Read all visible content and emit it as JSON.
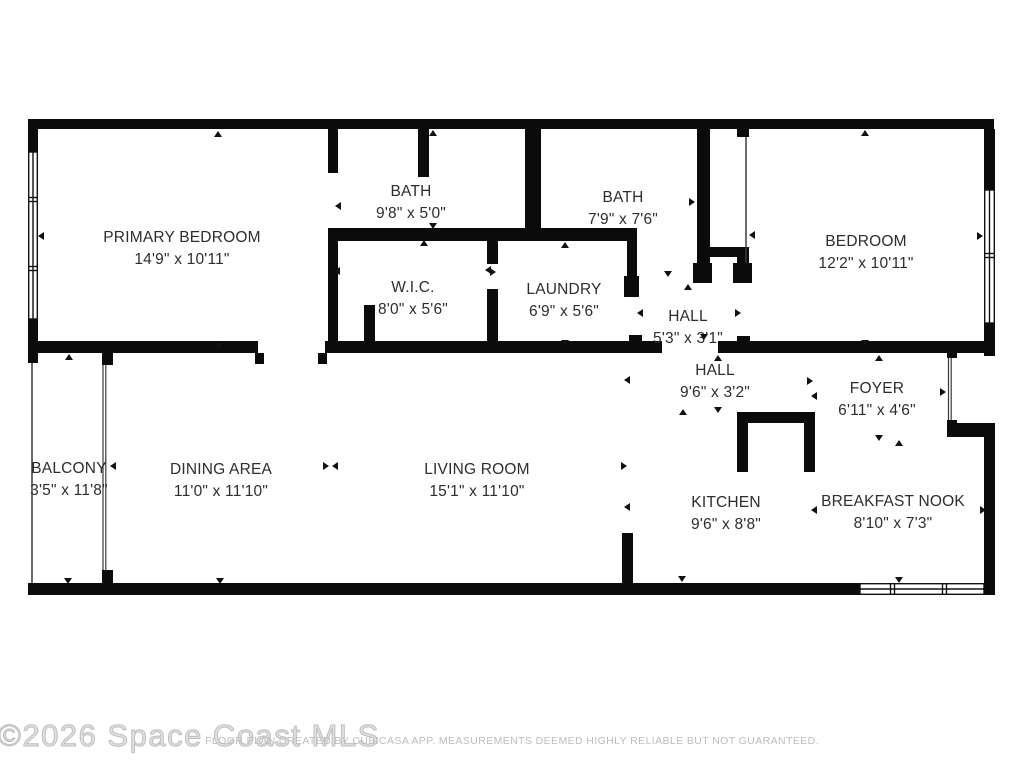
{
  "watermark": {
    "text": "©2026 Space Coast MLS"
  },
  "disclaimer": {
    "text": "FLOOR PLAN CREATED BY CUBICASA APP. MEASUREMENTS DEEMED HIGHLY RELIABLE BUT NOT GUARANTEED."
  },
  "colors": {
    "wall": "#0b0b0b",
    "label": "#2d2d2d",
    "watermark": "#bdbdbd",
    "disclaimer": "#bdbdbd",
    "background": "#ffffff"
  },
  "rooms": [
    {
      "id": "primary-bedroom",
      "name": "PRIMARY BEDROOM",
      "dims": "14'9\" x 10'11\""
    },
    {
      "id": "bath-1",
      "name": "BATH",
      "dims": "9'8\" x 5'0\""
    },
    {
      "id": "wic",
      "name": "W.I.C.",
      "dims": "8'0\" x 5'6\""
    },
    {
      "id": "laundry",
      "name": "LAUNDRY",
      "dims": "6'9\" x 5'6\""
    },
    {
      "id": "bath-2",
      "name": "BATH",
      "dims": "7'9\" x 7'6\""
    },
    {
      "id": "bedroom",
      "name": "BEDROOM",
      "dims": "12'2\" x 10'11\""
    },
    {
      "id": "hall-upper",
      "name": "HALL",
      "dims": "5'3\" x 3'1\""
    },
    {
      "id": "hall-lower",
      "name": "HALL",
      "dims": "9'6\" x 3'2\""
    },
    {
      "id": "foyer",
      "name": "FOYER",
      "dims": "6'11\" x 4'6\""
    },
    {
      "id": "kitchen",
      "name": "KITCHEN",
      "dims": "9'6\" x 8'8\""
    },
    {
      "id": "breakfast-nook",
      "name": "BREAKFAST NOOK",
      "dims": "8'10\" x 7'3\""
    },
    {
      "id": "living-room",
      "name": "LIVING ROOM",
      "dims": "15'1\" x 11'10\""
    },
    {
      "id": "dining-area",
      "name": "DINING AREA",
      "dims": "11'0\" x 11'10\""
    },
    {
      "id": "balcony",
      "name": "BALCONY",
      "dims": "3'5\" x 11'8\""
    }
  ],
  "markers": {
    "up": [
      [
        218,
        134
      ],
      [
        433,
        133
      ],
      [
        865,
        133
      ],
      [
        69,
        357
      ],
      [
        424,
        243
      ],
      [
        565,
        245
      ],
      [
        688,
        287
      ],
      [
        718,
        358
      ],
      [
        879,
        358
      ],
      [
        683,
        412
      ],
      [
        899,
        443
      ]
    ],
    "down": [
      [
        219,
        346
      ],
      [
        433,
        226
      ],
      [
        565,
        343
      ],
      [
        865,
        343
      ],
      [
        220,
        581
      ],
      [
        68,
        581
      ],
      [
        899,
        580
      ],
      [
        718,
        410
      ],
      [
        879,
        438
      ],
      [
        682,
        579
      ],
      [
        704,
        337
      ],
      [
        668,
        274
      ]
    ],
    "left": [
      [
        41,
        236
      ],
      [
        338,
        206
      ],
      [
        337,
        271
      ],
      [
        488,
        270
      ],
      [
        640,
        313
      ],
      [
        627,
        380
      ],
      [
        627,
        507
      ],
      [
        814,
        396
      ],
      [
        113,
        466
      ],
      [
        335,
        466
      ],
      [
        752,
        235
      ],
      [
        814,
        510
      ]
    ],
    "right": [
      [
        980,
        236
      ],
      [
        493,
        272
      ],
      [
        738,
        313
      ],
      [
        692,
        202
      ],
      [
        326,
        466
      ],
      [
        624,
        466
      ],
      [
        810,
        381
      ],
      [
        943,
        392
      ],
      [
        983,
        510
      ]
    ]
  }
}
